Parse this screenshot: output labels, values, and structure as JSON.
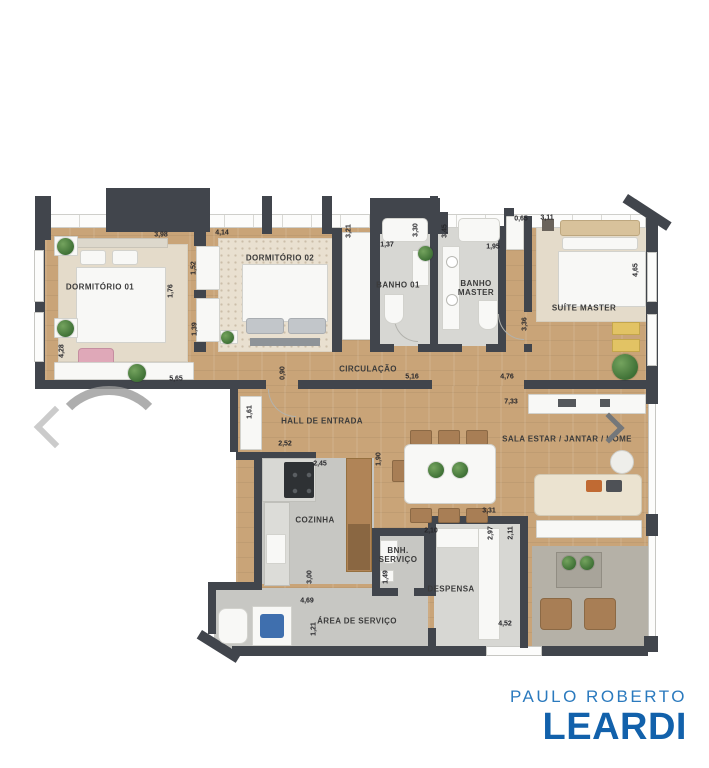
{
  "colors": {
    "wall": "#41454c",
    "wood_floor": "#c9a478",
    "tile_floor": "#c7c7c3",
    "brand_light_blue": "#2b7abe",
    "brand_dark_blue": "#1261ab"
  },
  "icons": {
    "prev": "chevron-left",
    "next": "chevron-right"
  },
  "rooms": {
    "dorm1": "DORMITÓRIO 01",
    "dorm2": "DORMITÓRIO 02",
    "banho1": "BANHO 01",
    "banhoMaster": "BANHO MASTER",
    "suite": "SUÍTE MASTER",
    "circulacao": "CIRCULAÇÃO",
    "hall": "HALL DE ENTRADA",
    "sala": "SALA ESTAR / JANTAR / HOME",
    "cozinha": "COZINHA",
    "bnhServico": "BNH. SERVIÇO",
    "despensa": "DESPENSA",
    "areaServico": "ÁREA DE SERVIÇO"
  },
  "dims": {
    "d398": "3,98",
    "d414": "4,14",
    "d321": "3,21",
    "d137": "1,37",
    "d330": "3,30",
    "d345": "3,45",
    "d195": "1,95",
    "d065": "0,65",
    "d311": "3,11",
    "d465": "4,65",
    "d152": "1,52",
    "d176": "1,76",
    "d139": "1,39",
    "d428": "4,28",
    "d565": "5,65",
    "d516": "5,16",
    "d476": "4,76",
    "d336": "3,36",
    "d090": "0,90",
    "d161": "1,61",
    "d252": "2,52",
    "d245": "2,45",
    "d190": "1,90",
    "d733": "7,33",
    "d331": "3,31",
    "d297": "2,97",
    "d211": "2,11",
    "d300": "3,00",
    "d469": "4,69",
    "d121": "1,21",
    "d210": "2,10",
    "d149": "1,49",
    "d452": "4,52"
  },
  "brand": {
    "line1": "PAULO ROBERTO",
    "line2": "LEARDI"
  }
}
